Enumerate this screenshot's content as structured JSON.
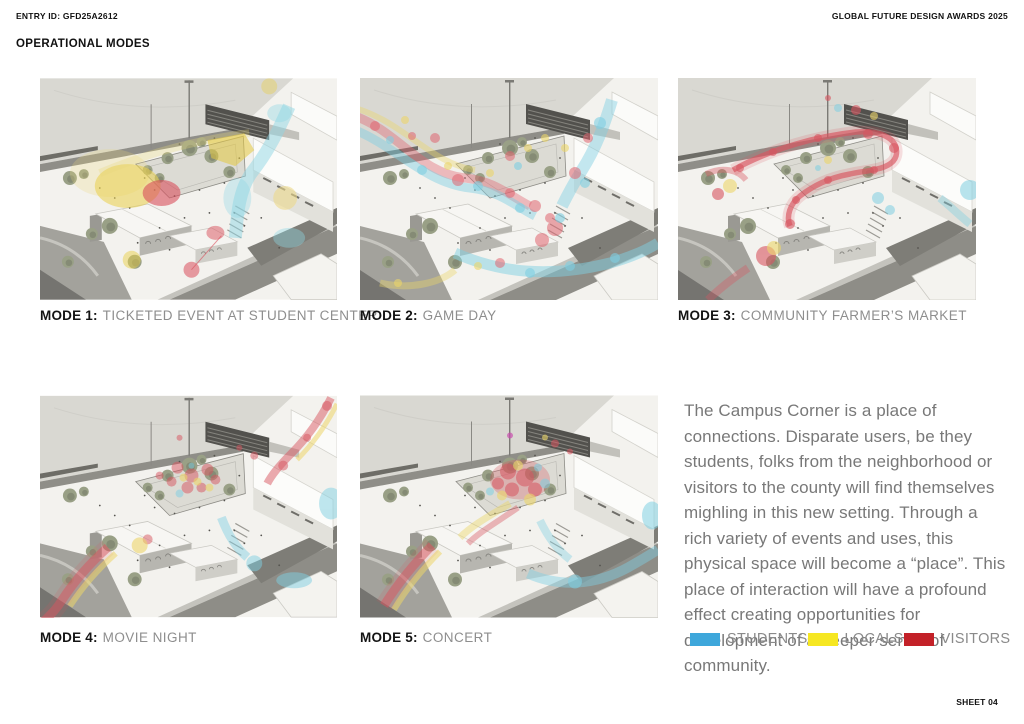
{
  "header": {
    "entry_id": "ENTRY ID: GFD25A2612",
    "award": "GLOBAL FUTURE DESIGN AWARDS 2025",
    "section_title": "OPERATIONAL MODES"
  },
  "modes": [
    {
      "label": "MODE 1:",
      "title": "TICKETED EVENT AT STUDENT CENTER"
    },
    {
      "label": "MODE 2:",
      "title": "GAME DAY"
    },
    {
      "label": "MODE 3:",
      "title": "COMMUNITY FARMER’S MARKET"
    },
    {
      "label": "MODE 4:",
      "title": "MOVIE NIGHT"
    },
    {
      "label": "MODE 5:",
      "title": "CONCERT"
    }
  ],
  "description": "The Campus Corner is a place of connections. Disparate users, be they students, folks from the neighborhood or visitors to the county will find themselves mighling in this new setting. Through a rich variety of events and uses, this physical space will become a “place”. This place of interaction will have a profound effect creating opportunities for development of a deeper sense of community.",
  "legend": [
    {
      "label": "STUDENTS",
      "color": "#3EA7DB"
    },
    {
      "label": "LOCALS",
      "color": "#F6E722"
    },
    {
      "label": "VISITORS",
      "color": "#C32128"
    }
  ],
  "footer": {
    "sheet": "SHEET 04"
  }
}
